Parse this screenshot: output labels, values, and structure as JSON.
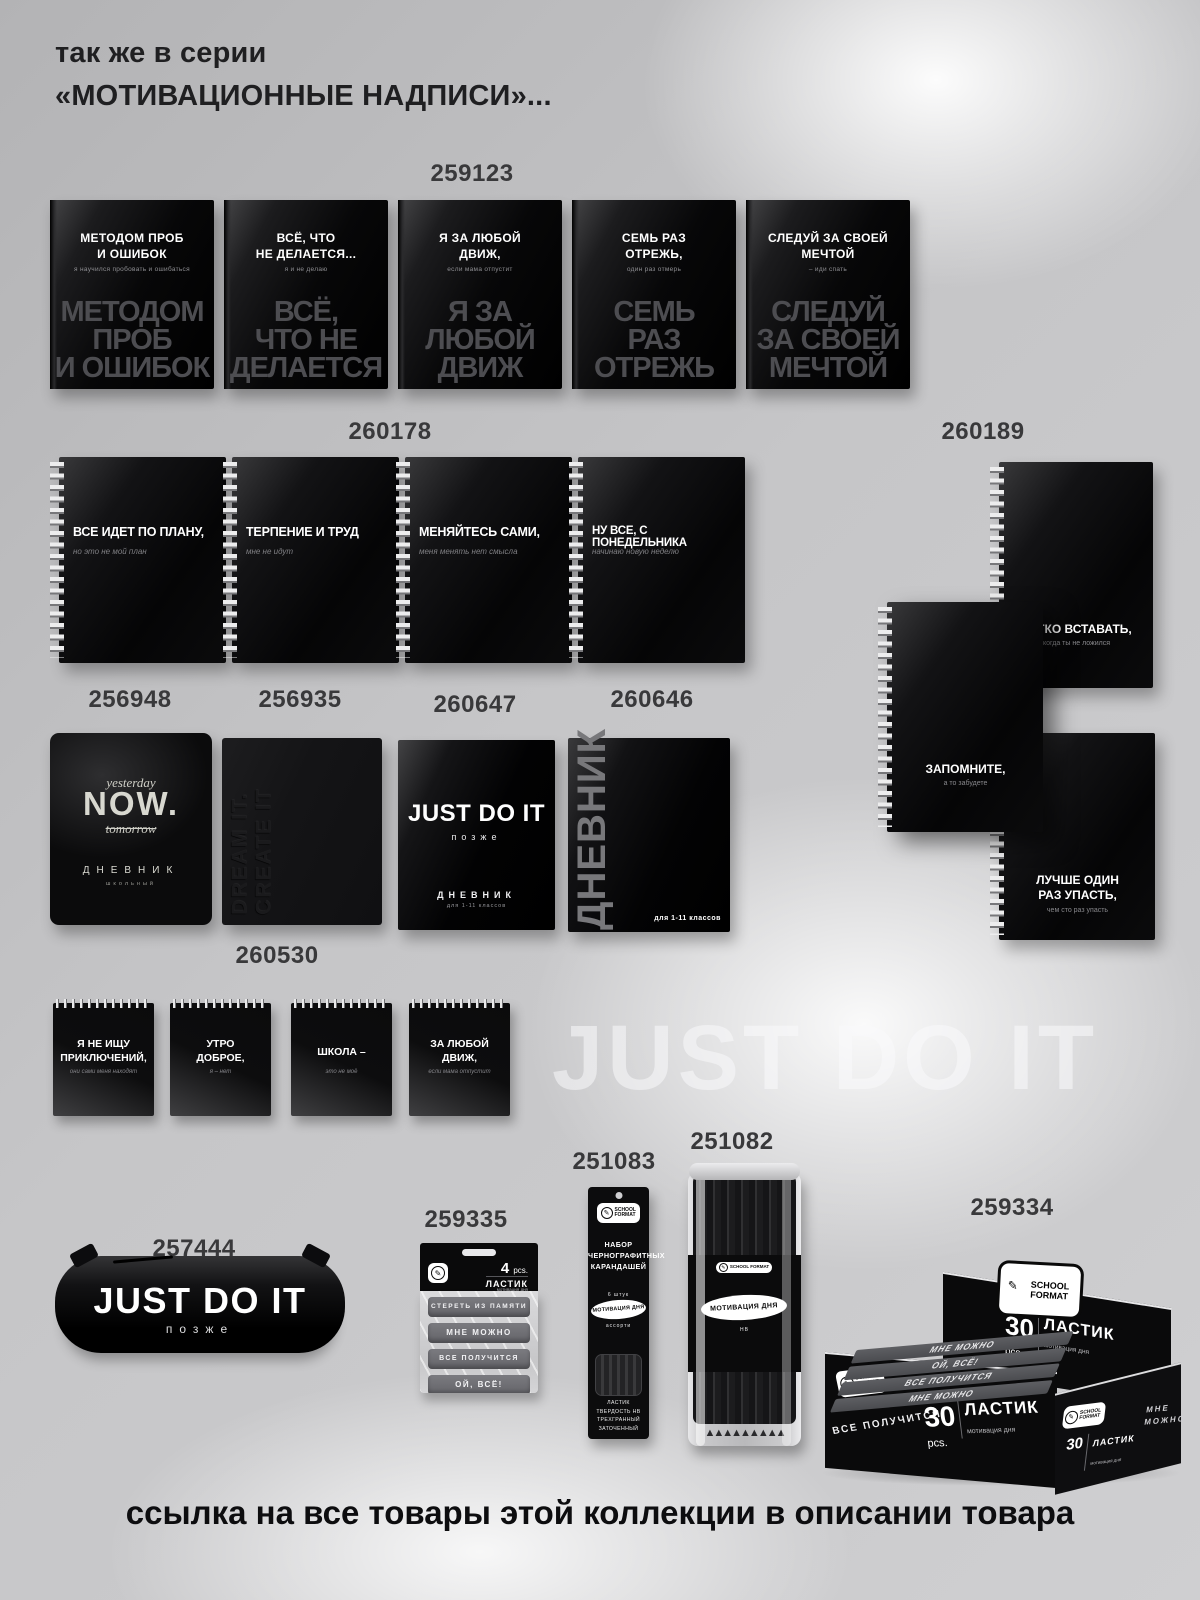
{
  "page": {
    "title_line1": "так же в серии",
    "title_line2": "«МОТИВАЦИОННЫЕ НАДПИСИ»...",
    "watermark": "JUST DO IT",
    "footer": "ссылка на все товары этой коллекции в описании товара",
    "brand": "SCHOOL FORMAT",
    "accent_black": "#0a0a0b",
    "background_gray": "#c6c6c8"
  },
  "row1": {
    "article": "259123",
    "items": [
      {
        "title": "МЕТОДОМ ПРОБ\nИ ОШИБОК",
        "subtitle": "я научился пробовать и ошибаться",
        "ghost": "МЕТОДОМ\nПРОБ\nИ ОШИБОК"
      },
      {
        "title": "ВСЁ, ЧТО\nНЕ ДЕЛАЕТСЯ...",
        "subtitle": "я и не делаю",
        "ghost": "ВСЁ,\nЧТО НЕ\nДЕЛАЕТСЯ"
      },
      {
        "title": "Я ЗА ЛЮБОЙ\nДВИЖ,",
        "subtitle": "если мама отпустит",
        "ghost": "Я ЗА\nЛЮБОЙ\nДВИЖ"
      },
      {
        "title": "СЕМЬ РАЗ\nОТРЕЖЬ,",
        "subtitle": "один раз отмерь",
        "ghost": "СЕМЬ\nРАЗ\nОТРЕЖЬ"
      },
      {
        "title": "СЛЕДУЙ ЗА СВОЕЙ\nМЕЧТОЙ",
        "subtitle": "– иди спать",
        "ghost": "СЛЕДУЙ\nЗА СВОЕЙ\nМЕЧТОЙ"
      }
    ]
  },
  "row2": {
    "article": "260178",
    "items": [
      {
        "title": "ВСЕ ИДЕТ ПО ПЛАНУ,",
        "subtitle": "но это не мой план"
      },
      {
        "title": "ТЕРПЕНИЕ И ТРУД",
        "subtitle": "мне не идут"
      },
      {
        "title": "МЕНЯЙТЕСЬ САМИ,",
        "subtitle": "меня менять нет смысла"
      },
      {
        "title": "НУ ВСЕ, С ПОНЕДЕЛЬНИКА",
        "subtitle": "начинаю новую неделю"
      }
    ]
  },
  "rightcol": {
    "article": "260189",
    "items": [
      {
        "title": "ЛЕГКО ВСТАВАТЬ,",
        "subtitle": "когда ты не ложился"
      },
      {
        "title": "ЗАПОМНИТЕ,",
        "subtitle": "а то забудете"
      },
      {
        "title": "ЛУЧШЕ ОДИН\nРАЗ УПАСТЬ,",
        "subtitle": "чем сто раз упасть"
      }
    ]
  },
  "diaries": {
    "now": {
      "article": "256948",
      "top": "yesterday",
      "main": "NOW.",
      "bottom": "tomorrow",
      "label": "ДНЕВНИК",
      "sublabel": "школьный"
    },
    "dream": {
      "article": "256935",
      "embossed": "DREAM IT. CREATE IT"
    },
    "later": {
      "article": "260647",
      "main": "JUST DO IT",
      "sub": "позже",
      "label": "ДНЕВНИК",
      "sublabel": "для 1-11 классов"
    },
    "dnevnik": {
      "article": "260646",
      "vertical": "ДНЕВНИК",
      "corner": "для 1-11 классов"
    }
  },
  "notepads": {
    "article": "260530",
    "items": [
      {
        "title": "Я НЕ ИЩУ\nПРИКЛЮЧЕНИЙ,",
        "subtitle": "они сами меня находят"
      },
      {
        "title": "УТРО\nДОБРОЕ,",
        "subtitle": "я – нет"
      },
      {
        "title": "ШКОЛА –",
        "subtitle": "это не моё"
      },
      {
        "title": "ЗА ЛЮБОЙ\nДВИЖ,",
        "subtitle": "если мама отпустит"
      }
    ]
  },
  "case": {
    "article": "257444",
    "main": "JUST DO IT",
    "sub": "позже"
  },
  "eraserpack": {
    "article": "259335",
    "count": "4",
    "unit": "pcs.",
    "label": "ЛАСТИК",
    "sublabel": "мотивация дня",
    "erasers": [
      "СТЕРЕТЬ ИЗ ПАМЯТИ",
      "МНЕ МОЖНО",
      "ВСЕ ПОЛУЧИТСЯ",
      "ОЙ, ВСЁ!"
    ]
  },
  "pencilset": {
    "article": "251083",
    "title": "НАБОР\nЧЕРНОГРАФИТНЫХ\nКАРАНДАШЕЙ",
    "count": "6 штук",
    "badge": "МОТИВАЦИЯ ДНЯ",
    "assort": "ассорти",
    "specs": "ЛАСТИК\nТВЕРДОСТЬ HB\nТРЕХГРАННЫЙ\nЗАТОЧЕННЫЙ"
  },
  "tube": {
    "article": "251082",
    "badge": "МОТИВАЦИЯ ДНЯ",
    "spec": "НВ",
    "tips": "▲▲▲▲▲▲▲▲▲"
  },
  "box": {
    "article": "259334",
    "count": "30",
    "unit": "pcs.",
    "label": "ЛАСТИК",
    "sublabel": "мотивация дня",
    "side_text": "ВСЕ ПОЛУЧИТСЯ",
    "right_text": "МНЕ МОЖНО",
    "eraser_texts": [
      "МНЕ МОЖНО",
      "ОЙ, ВСЁ!",
      "ВСЕ ПОЛУЧИТСЯ",
      "МНЕ МОЖНО"
    ]
  }
}
